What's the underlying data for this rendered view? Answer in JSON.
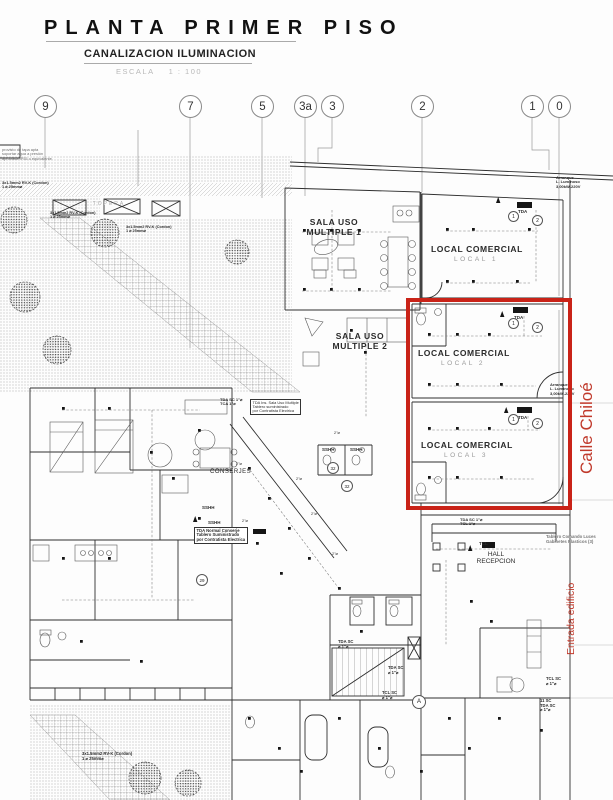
{
  "title_block": {
    "title": "PLANTA PRIMER PISO",
    "subtitle": "CANALIZACION ILUMINACION",
    "scale_label": "ESCALA",
    "scale_ratio": "1 : 100"
  },
  "grid_bubbles": [
    "9",
    "7",
    "5",
    "3a",
    "3",
    "2",
    "1",
    "0"
  ],
  "rooms": {
    "sala_uso_1a": "SALA USO",
    "sala_uso_1b": "MULTIPLE 1",
    "sala_uso_2a": "SALA USO",
    "sala_uso_2b": "MULTIPLE 2",
    "local_comercial": "LOCAL COMERCIAL",
    "local_1": "LOCAL  1",
    "local_2": "LOCAL  2",
    "local_3": "LOCAL  3",
    "conserjes": "CONSERJES",
    "hall_1": "HALL",
    "hall_2": "RECEPCION",
    "sshh": "SSHH",
    "topera": "TOPERA"
  },
  "street_labels": {
    "calle": "Calle Chiloé",
    "entrada": "Entrada edificio"
  },
  "annotations": {
    "arranque_1": "Arranque",
    "arranque_2": "L. Luminoso",
    "arranque_3": "3,00kW-220V",
    "tda": "TDA",
    "tda_sala_1": "TDA Ins. Sala Uso Multiple",
    "tda_sala_2": "Tablero suministrado",
    "tda_sala_3": "por Contratista Electrica",
    "tda_sc": "TDA SC 1\"⌀",
    "tca": "TCA 1\"⌀",
    "tcl_1in": "TCL 1\"⌀",
    "tda_conserje_1": "TDA Normal Conserje",
    "tda_conserje_2": "Tablero Suministrado",
    "tda_conserje_3": "por Contratista Electrica",
    "tablero_comando_1": "Tablero Comando Luces",
    "tablero_comando_2": "Gabinetes Plasticos (3)",
    "tcl": "TCL",
    "tcl_sc": "TCL SC",
    "tda_sc_short": "TDA SC",
    "dia_1": "⌀ 1\"⌀",
    "dia_2": "2\"⌀",
    "sc_11": "11 SC",
    "cordon_1": "3x1.5mm2 RV-K (Cordon)",
    "cordon_2": "1 ⌀ 25mm⌀",
    "caja_1": "provisto de tapa apta",
    "caja_2": "soportar agua a presión",
    "caja_3": "aprobada IP55 o equivalente.",
    "badge_1": "1",
    "badge_2": "2",
    "badge_32": "32",
    "badge_29": "29",
    "badge_a": "A"
  },
  "colors": {
    "highlight_rectangle": "#c92318",
    "street_text": "#c0392b",
    "linework": "#2f2f2f"
  }
}
